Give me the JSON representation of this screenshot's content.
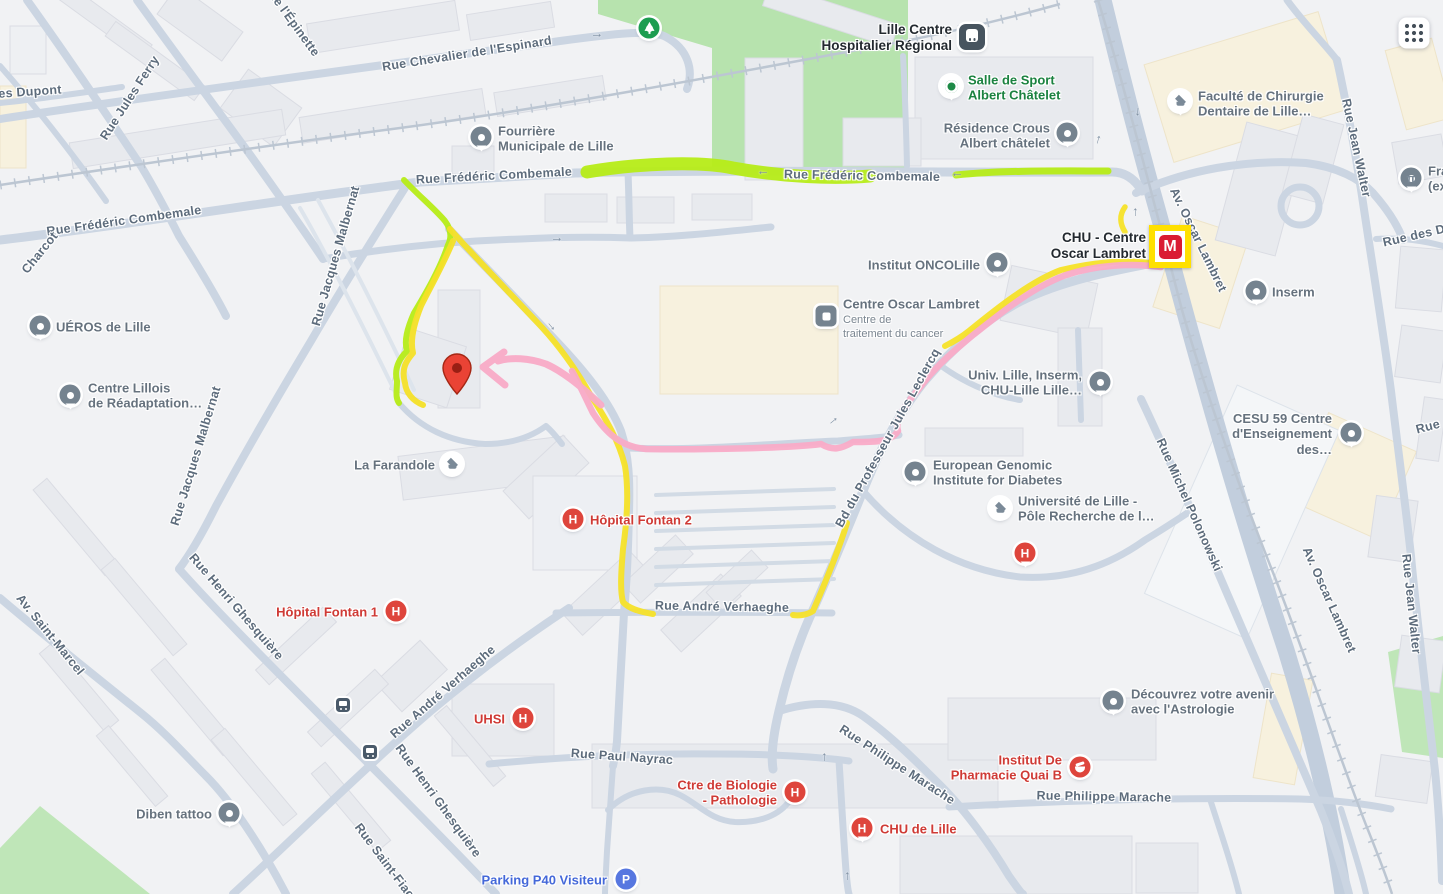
{
  "map": {
    "style": "google-maps-light-blue-roads",
    "colors": {
      "land": "#f1f2f4",
      "road": "#cbd5e2",
      "road_major": "#c2cedd",
      "building": "#e8eaee",
      "campus_building": "#f7f1de",
      "park_green": "#b7e3ae",
      "route_yellow": "#f5e128",
      "route_chartreuse": "#b6ec17",
      "route_pink": "#f9abc7",
      "street_label": "#5d6c7c",
      "poi_label_gray": "#66727e",
      "poi_label_health": "#cf3a35",
      "poi_label_green": "#1b8240",
      "poi_label_parking": "#4468d9",
      "station_label": "#23292f",
      "destination_pin": "#ea4335",
      "metro_logo_red": "#da1a32",
      "metro_logo_yellow": "#ffe000"
    },
    "icons": {
      "hospital_glyph": "H",
      "metro_glyph": "M",
      "parking_glyph": "P",
      "bank_glyph": "π",
      "arrow_glyph": "→"
    },
    "streets": [
      {
        "text": "es Dupont"
      },
      {
        "text": "Rue Jules Ferry"
      },
      {
        "text": "Rue Chevalier de l'Espinard"
      },
      {
        "text": "de l'Épinette"
      },
      {
        "text": "Rue Frédéric Combemale"
      },
      {
        "text": "Charcot"
      },
      {
        "text": "Rue Frédéric Combemale"
      },
      {
        "text": "Rue Frédéric Combemale"
      },
      {
        "text": "Rue Jacques Malbernat"
      },
      {
        "text": "Rue Jacques Malbernat"
      },
      {
        "text": "Rue Henri Ghesquière"
      },
      {
        "text": "Rue Henri Ghesquière"
      },
      {
        "text": "Rue Saint-Fiacre"
      },
      {
        "text": "Av. Saint-Marcel"
      },
      {
        "text": "Rue André Verhaeghe"
      },
      {
        "text": "Rue André Verhaeghe"
      },
      {
        "text": "Rue Paul Nayrac"
      },
      {
        "text": "Bd du Professeur Jules Leclercq"
      },
      {
        "text": "Rue Philippe Marache"
      },
      {
        "text": "Rue Philippe Marache"
      },
      {
        "text": "Av. Oscar Lambret"
      },
      {
        "text": "Av. Oscar Lambret"
      },
      {
        "text": "Rue Michel Polonowski"
      },
      {
        "text": "Rue Jean Walter"
      },
      {
        "text": "Rue Jean Walter"
      },
      {
        "text": "Rue des D"
      },
      {
        "text": "Rue"
      }
    ],
    "pois": {
      "lille_chr": {
        "text": "Lille Centre\nHospitalier Régional"
      },
      "chu_metro": {
        "text": "CHU - Centre\nOscar Lambret"
      },
      "salle_sport": {
        "text": "Salle de Sport\nAlbert Châtelet"
      },
      "residence_crous": {
        "text": "Résidence Crous\nAlbert châtelet"
      },
      "faculte_dentaire": {
        "text": "Faculté de Chirurgie\nDentaire de Lille…"
      },
      "fourriere": {
        "text": "Fourrière\nMunicipale de Lille"
      },
      "institut_oncolille": {
        "text": "Institut ONCOLille"
      },
      "centre_oscar_lambret": {
        "title": "Centre Oscar Lambret",
        "subtitle": "Centre de\ntraitement du cancer"
      },
      "ueros": {
        "text": "UÉROS de Lille"
      },
      "centre_lillois": {
        "text": "Centre Lillois\nde Réadaptation…"
      },
      "univ_lille_inserm": {
        "text": "Univ. Lille, Inserm,\nCHU-Lille Lille…"
      },
      "inserm": {
        "text": "Inserm"
      },
      "fra_bank": {
        "text": "Fra\n(ex"
      },
      "cesu59": {
        "text": "CESU 59 Centre\nd'Enseignement des…"
      },
      "egid": {
        "text": "European Genomic\nInstitute for Diabetes"
      },
      "univ_pole": {
        "text": "Université de Lille -\nPôle Recherche de l…"
      },
      "la_farandole": {
        "text": "La Farandole"
      },
      "hopital_fontan2": {
        "text": "Hôpital Fontan 2"
      },
      "hopital_fontan1": {
        "text": "Hôpital Fontan 1"
      },
      "uhsi": {
        "text": "UHSI"
      },
      "astrologie": {
        "text": "Découvrez votre avenir\navec l'Astrologie"
      },
      "diben": {
        "text": "Diben tattoo"
      },
      "pharmacie": {
        "text": "Institut De\nPharmacie Quai B"
      },
      "chu_de_lille": {
        "text": "CHU de Lille"
      },
      "biologie": {
        "text": "Ctre de Biologie\n- Pathologie"
      },
      "parking_p40": {
        "text": "Parking P40 Visiteur"
      }
    }
  }
}
